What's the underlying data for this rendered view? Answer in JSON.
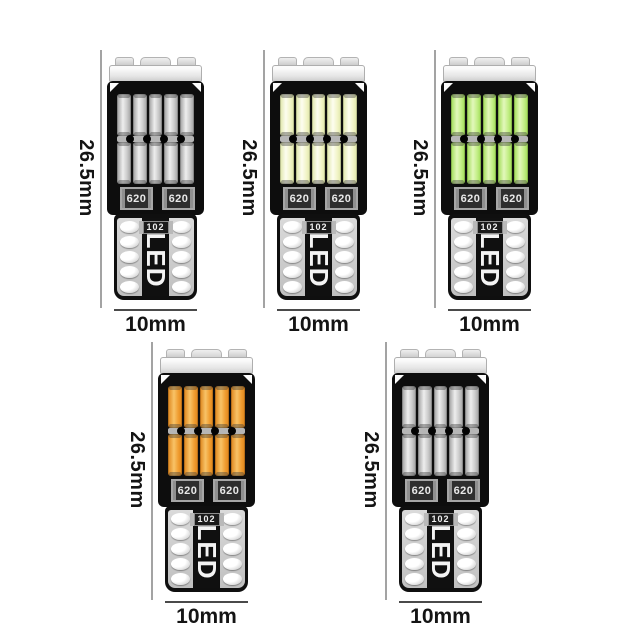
{
  "image": {
    "subject": "T10 W5W wedge LED bulbs, five color variants with dimensions",
    "background_color": "#ffffff"
  },
  "dimensions": {
    "height_mm": 26.5,
    "width_mm": 10
  },
  "bulbs": [
    {
      "variant": "cool-white-unlit",
      "position": "top-left",
      "height_label": "26.5mm",
      "width_label": "10mm",
      "base_text": "LED",
      "resistor_left": "620",
      "resistor_right": "620",
      "component": "102",
      "led_dark": "#9e9e9e",
      "led_main": "#c7c7c7",
      "led_light": "#eeeeee"
    },
    {
      "variant": "warm-white-lit",
      "position": "top-center",
      "height_label": "26.5mm",
      "width_label": "10mm",
      "base_text": "LED",
      "resistor_left": "620",
      "resistor_right": "620",
      "component": "102",
      "led_dark": "#dfe6a8",
      "led_main": "#f1f4c6",
      "led_light": "#fdfdf0"
    },
    {
      "variant": "green-lit",
      "position": "top-right",
      "height_label": "26.5mm",
      "width_label": "10mm",
      "base_text": "LED",
      "resistor_left": "620",
      "resistor_right": "620",
      "component": "102",
      "led_dark": "#9edb54",
      "led_main": "#c1ed83",
      "led_light": "#e3f8bb"
    },
    {
      "variant": "amber-lit",
      "position": "bottom-left",
      "height_label": "26.5mm",
      "width_label": "10mm",
      "base_text": "LED",
      "resistor_left": "620",
      "resistor_right": "620",
      "component": "102",
      "led_dark": "#dd841b",
      "led_main": "#ef9c2f",
      "led_light": "#f8c367"
    },
    {
      "variant": "cool-white-unlit",
      "position": "bottom-right",
      "height_label": "26.5mm",
      "width_label": "10mm",
      "base_text": "LED",
      "resistor_left": "620",
      "resistor_right": "620",
      "component": "102",
      "led_dark": "#9e9e9e",
      "led_main": "#c7c7c7",
      "led_light": "#eeeeee"
    }
  ]
}
